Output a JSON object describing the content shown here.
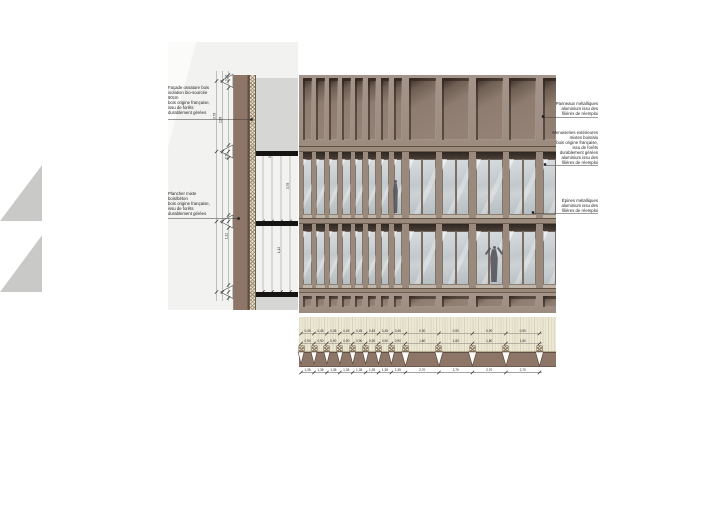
{
  "title": "Façade bois — détail de coupe, élévation et plan",
  "colors": {
    "facade_fin": "#a09083",
    "facade_base": "#7b6a61",
    "niche_shadow": "#473b33",
    "floor_band": "#9a8a7d",
    "glass": "#c2c9cd",
    "soffit": "#2e2722",
    "timber_wall": "#8d7567",
    "insulation": "#e7decb",
    "concrete": "#d6d6d4",
    "slab_black": "#161412",
    "plan_cream": "#ebe7d2",
    "plan_brown": "#8d7668",
    "figure": "#53525a"
  },
  "section_annotations": [
    {
      "lines": [
        "Façade ossature bois",
        "isolation bio-sourcée",
        "60cm",
        "bois origine française,",
        "issu de forêts",
        "durablement gérées"
      ]
    },
    {
      "lines": [
        "Plancher mixte",
        "bois/béton",
        "bois origine française,",
        "issu de forêts",
        "durablement gérées"
      ]
    }
  ],
  "right_annotations": [
    {
      "lines": [
        "Panneaux métalliques",
        "aluminium issu des",
        "filières de réemploi"
      ]
    },
    {
      "lines": [
        "Menuiseries extérieures",
        "mixtes bois/alu",
        "bois origine française,",
        "issu de forêts",
        "durablement gérées",
        "aluminium issu des",
        "filières de réemploi"
      ]
    },
    {
      "lines": [
        "Épines métalliques",
        "aluminium issu des",
        "filières de réemploi"
      ]
    }
  ],
  "dimensions": {
    "vertical_labels": [
      "0,26",
      "3,78",
      "0,70",
      "2,88",
      "1,12"
    ],
    "plan_row1_narrow": "0,45",
    "plan_row1_wide": "0,90",
    "plan_row2_narrow": "0,90",
    "plan_row2_wide": "1,80",
    "plan_bottom_narrow": "1,35",
    "plan_bottom_wide": "2,70"
  }
}
